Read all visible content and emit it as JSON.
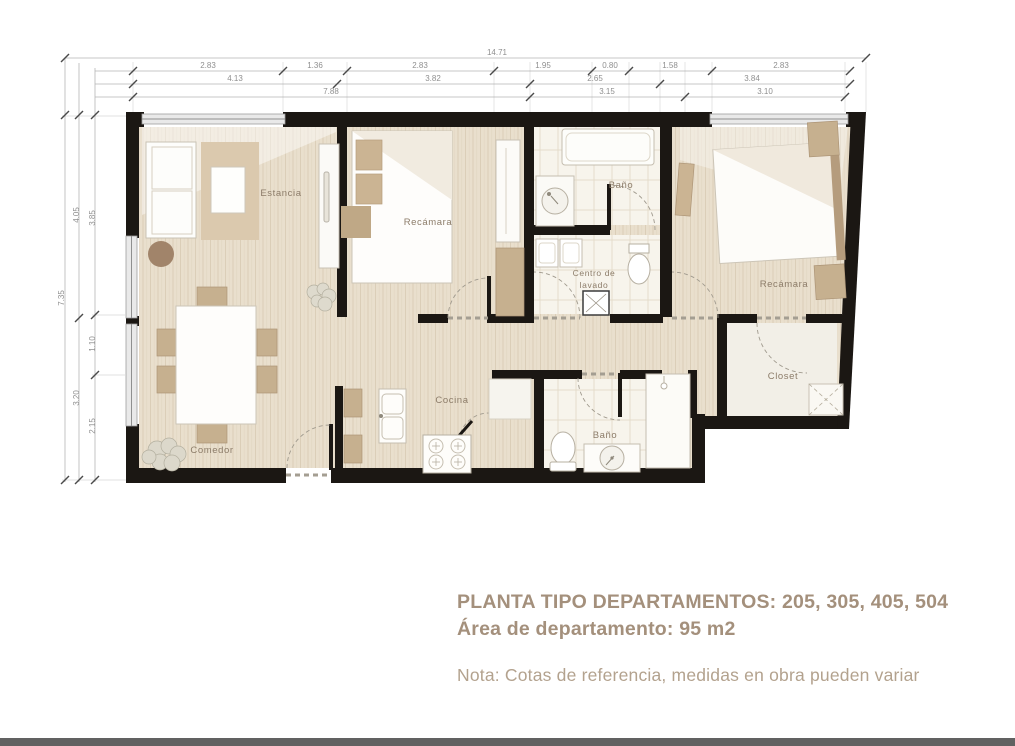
{
  "plan": {
    "rooms": {
      "estancia": "Estancia",
      "recamara1": "Recámara",
      "bano1": "Baño",
      "centro_lavado_l1": "Centro de",
      "centro_lavado_l2": "lavado",
      "recamara2": "Recámara",
      "closet": "Closet",
      "cocina": "Cocina",
      "comedor": "Comedor",
      "bano2": "Baño"
    },
    "dimensions": {
      "top": {
        "overall": "14.71",
        "tier1": [
          "2.83",
          "1.36",
          "2.83",
          "1.95",
          "0.80",
          "1.58",
          "2.83"
        ],
        "tier2": [
          "4.13",
          "3.82",
          "2.65",
          "3.84"
        ],
        "tier3": [
          "7.88",
          "3.15",
          "3.10"
        ]
      },
      "left": {
        "overall": "7.35",
        "outer": [
          "4.05",
          "3.20"
        ],
        "inner": [
          "3.85",
          "1.10",
          "2.15"
        ]
      }
    }
  },
  "title_block": {
    "line1": "PLANTA TIPO DEPARTAMENTOS: 205, 305, 405, 504",
    "line2": "Área de departamento: 95 m2",
    "note": "Nota: Cotas de referencia, medidas en obra pueden variar"
  },
  "colors": {
    "title_text": "#a4907c",
    "note_text": "#b3a28e",
    "walls": "#1b1713",
    "floor_wood": "#e9dfcd",
    "furniture_tan": "#c6b08f",
    "dim_text": "#8f8f8f",
    "bottom_bar": "#616161"
  }
}
